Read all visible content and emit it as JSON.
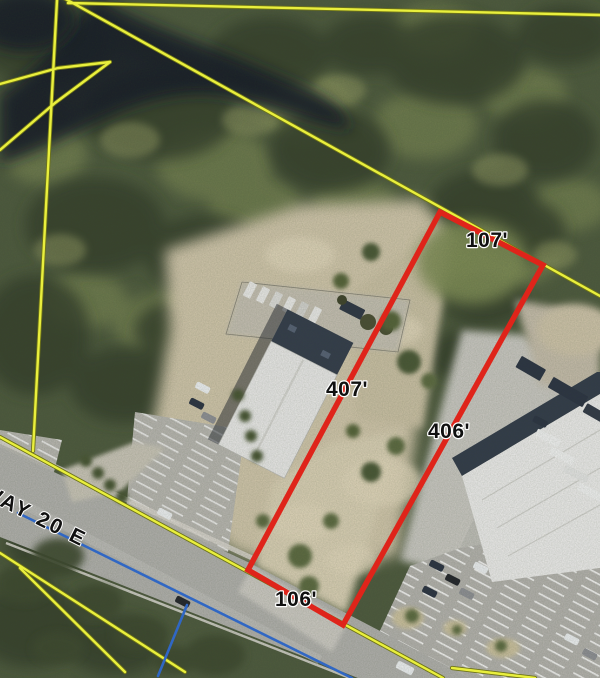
{
  "colors": {
    "parcel_red": "#df241a",
    "boundary_yellow": "#e9ef3d",
    "boundary_yellow_casing": "#6e7318",
    "boundary_blue": "#3067c4",
    "label_text": "#101010",
    "label_halo": "#ffffff"
  },
  "parcel": {
    "dimensions": {
      "north": "107'",
      "west": "407'",
      "east": "406'",
      "south": "106'"
    }
  },
  "road": {
    "label": "WAY 20 E"
  }
}
